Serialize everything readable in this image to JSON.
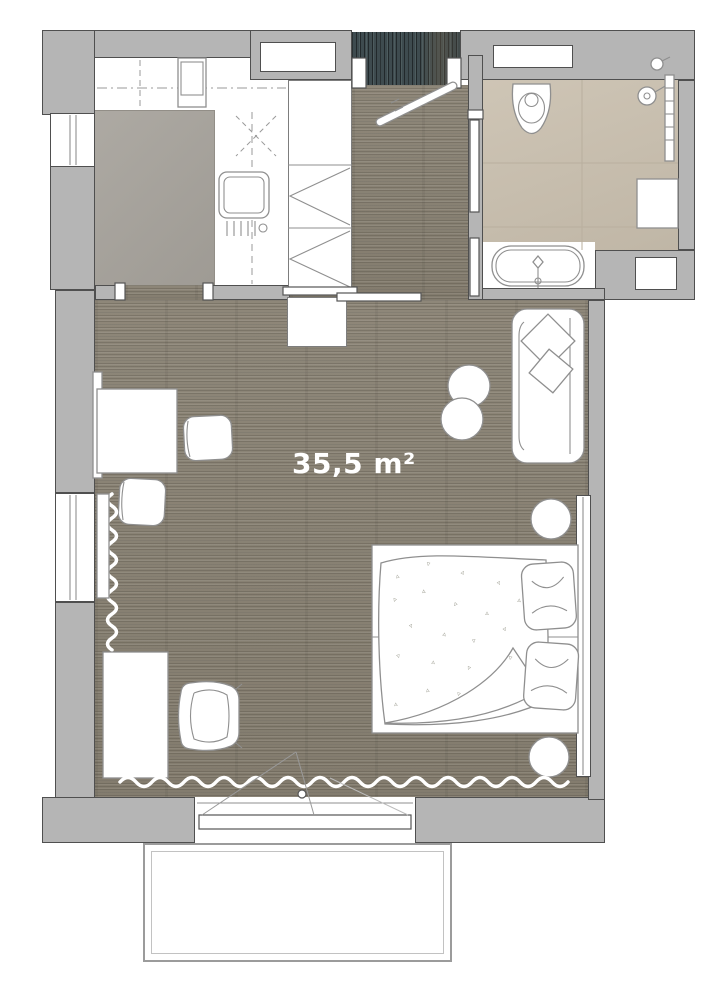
{
  "plan": {
    "area_label": "35,5 m²"
  },
  "colors": {
    "wall_fill": "#b5b5b5",
    "wall_outline": "#4f4f4f",
    "wood_floor": "#8b8476",
    "entry_mat": "#3e4b4f",
    "kitchen_tile": "#a8a49d",
    "bath_tile": "#cac0af",
    "bath_grout": "#b9af9e",
    "furniture_fill": "#ffffff",
    "furniture_stroke": "#8f8f8f",
    "label_text": "#ffffff"
  },
  "furniture": [
    "kitchen-counter",
    "cooktop",
    "kitchen-sink",
    "wardrobe",
    "entry-door",
    "sliding-doors",
    "toilet",
    "shower",
    "towel-radiator",
    "bath-cabinet",
    "bathtub",
    "sofa",
    "sofa-pillows",
    "side-tables",
    "desk",
    "chairs",
    "office-chair",
    "double-bed",
    "bed-pillows",
    "nightstands",
    "radiators",
    "curtain",
    "balcony-door",
    "balcony"
  ],
  "decor": {
    "confetti_glyphs": [
      "▵",
      "▿"
    ]
  }
}
